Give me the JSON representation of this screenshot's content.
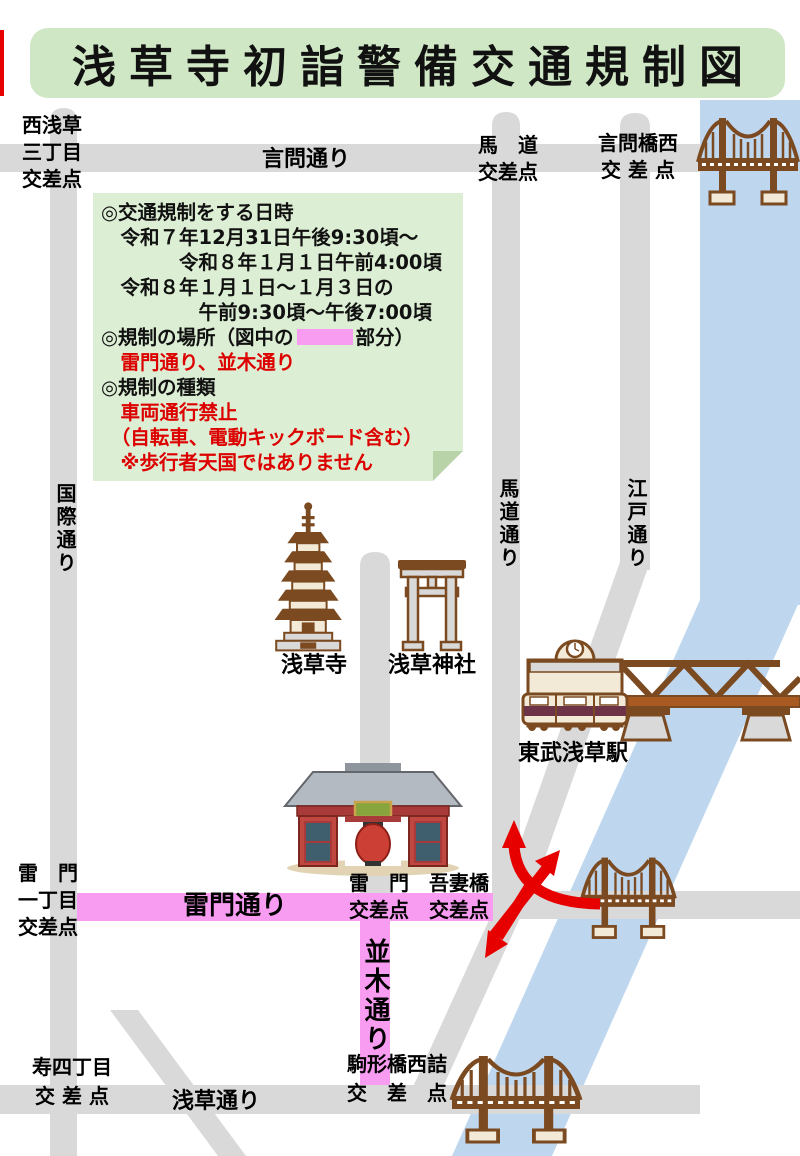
{
  "title": "浅草寺初詣警備交通規制図",
  "info_box": {
    "heading_datetime": "◎交通規制をする日時",
    "datetime_1": "　令和７年12月31日午後9:30頃～",
    "datetime_2": "　　　　令和８年１月１日午前4:00頃",
    "datetime_3": "　令和８年１月１日～１月３日の",
    "datetime_4": "　　　　　午前9:30頃～午後7:00頃",
    "place_prefix": "◎規制の場所（図中の",
    "place_suffix": "部分）",
    "place_roads": "　雷門通り、並木通り",
    "heading_type": "◎規制の種類",
    "type_1": "　車両通行禁止",
    "type_2": "　（自転車、電動キックボード含む）",
    "type_3": "　※歩行者天国ではありません"
  },
  "map": {
    "labels": {
      "nishi_asakusa_kosaten": "西浅草\n三丁目\n交差点",
      "kototoi_dori": "言問通り",
      "umamichi_kosaten": "馬　道\n交差点",
      "kototoibashi_nishi_kosaten": "言問橋西\n交 差 点",
      "kokusai_dori": "国際通り",
      "umamichi_dori": "馬道通り",
      "edo_dori": "江戸通り",
      "sensoji": "浅草寺",
      "asakusa_jinja": "浅草神社",
      "tobu_asakusa_station": "東武浅草駅",
      "kaminarimon_itchome_kosaten": "雷　門\n一丁目\n交差点",
      "kaminarimon_dori": "雷門通り",
      "kaminarimon_kosaten": "雷　門\n交差点",
      "azumabashi_kosaten": "吾妻橋\n交差点",
      "namiki_dori": "並木通り",
      "komagatabashi_nishizume_kosaten": "駒形橋西詰\n交　差　点",
      "kotobuki_yonchome_kosaten": "寿四丁目\n交 差 点",
      "asakusa_dori": "浅草通り"
    },
    "icons": [
      "suspension-bridge-icon",
      "pagoda-icon",
      "torii-icon",
      "station-icon",
      "train-icon",
      "truss-bridge-icon",
      "kaminarimon-gate-icon",
      "red-arrows-icon"
    ]
  },
  "colors": {
    "title_bg": "#cfe7c5",
    "info_bg": "#dceed3",
    "road_gray": "#d9d9d9",
    "river_blue": "#bed7ef",
    "regulated_pink": "#f89cf2",
    "warning_red": "#dd0000",
    "arrow_red": "#e60000",
    "icon_brown": "#7b4a21"
  }
}
